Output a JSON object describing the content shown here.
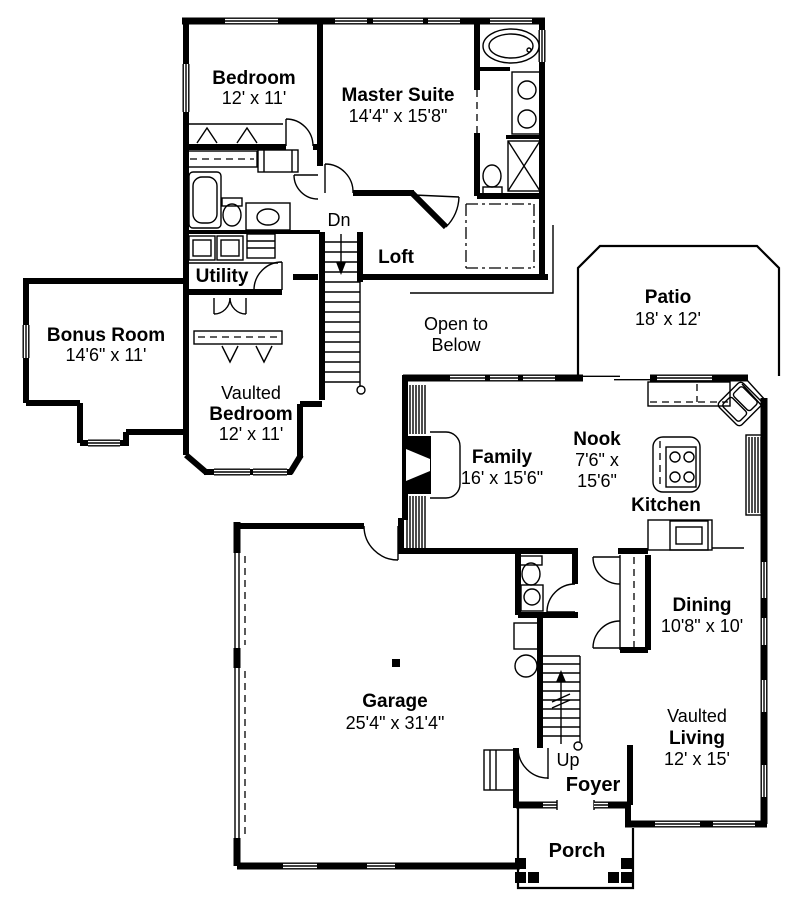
{
  "colors": {
    "ink": "#000000",
    "paper": "#ffffff"
  },
  "labels": {
    "bedroom": {
      "name": "Bedroom",
      "dims": "12' x 11'"
    },
    "master_suite": {
      "name": "Master Suite",
      "dims": "14'4\" x 15'8\""
    },
    "dn": {
      "name": "Dn"
    },
    "loft": {
      "name": "Loft"
    },
    "utility": {
      "name": "Utility"
    },
    "bonus_room": {
      "name": "Bonus Room",
      "dims": "14'6\" x 11'"
    },
    "open_to_below": {
      "line1": "Open to",
      "line2": "Below"
    },
    "vaulted_bedroom": {
      "prefix": "Vaulted",
      "name": "Bedroom",
      "dims": "12' x 11'"
    },
    "patio": {
      "name": "Patio",
      "dims": "18' x 12'"
    },
    "family": {
      "name": "Family",
      "dims": "16' x 15'6\""
    },
    "nook": {
      "name": "Nook",
      "dims_line1": "7'6\" x",
      "dims_line2": "15'6\""
    },
    "kitchen": {
      "name": "Kitchen"
    },
    "dining": {
      "name": "Dining",
      "dims": "10'8\" x 10'"
    },
    "garage": {
      "name": "Garage",
      "dims": "25'4\" x 31'4\""
    },
    "up": {
      "name": "Up"
    },
    "foyer": {
      "name": "Foyer"
    },
    "vaulted_living": {
      "prefix": "Vaulted",
      "name": "Living",
      "dims": "12' x 15'"
    },
    "porch": {
      "name": "Porch"
    }
  }
}
